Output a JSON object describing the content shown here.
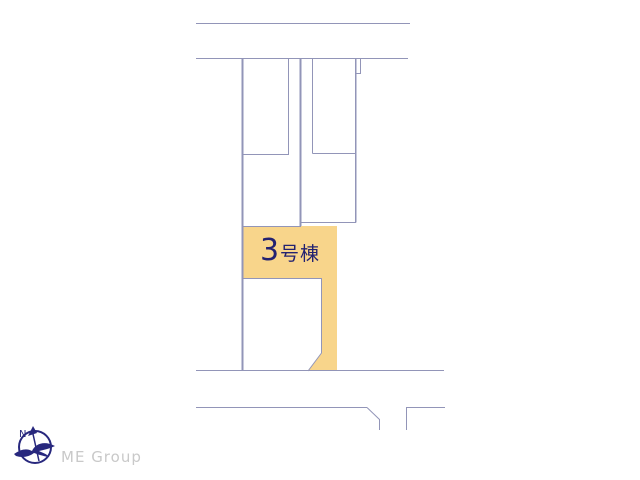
{
  "page": {
    "background_color": "#FFFFFF"
  },
  "site_plan": {
    "line_color": "#9295B8",
    "highlighted_plot": {
      "label_number": "3",
      "label_suffix": "号棟",
      "fill_color": "#F8D58B",
      "label_color": "#232271"
    }
  },
  "compass": {
    "north_label": "N",
    "color": "#28287E"
  },
  "branding": {
    "name": "ME Group",
    "text_color": "#C9C9C9"
  }
}
